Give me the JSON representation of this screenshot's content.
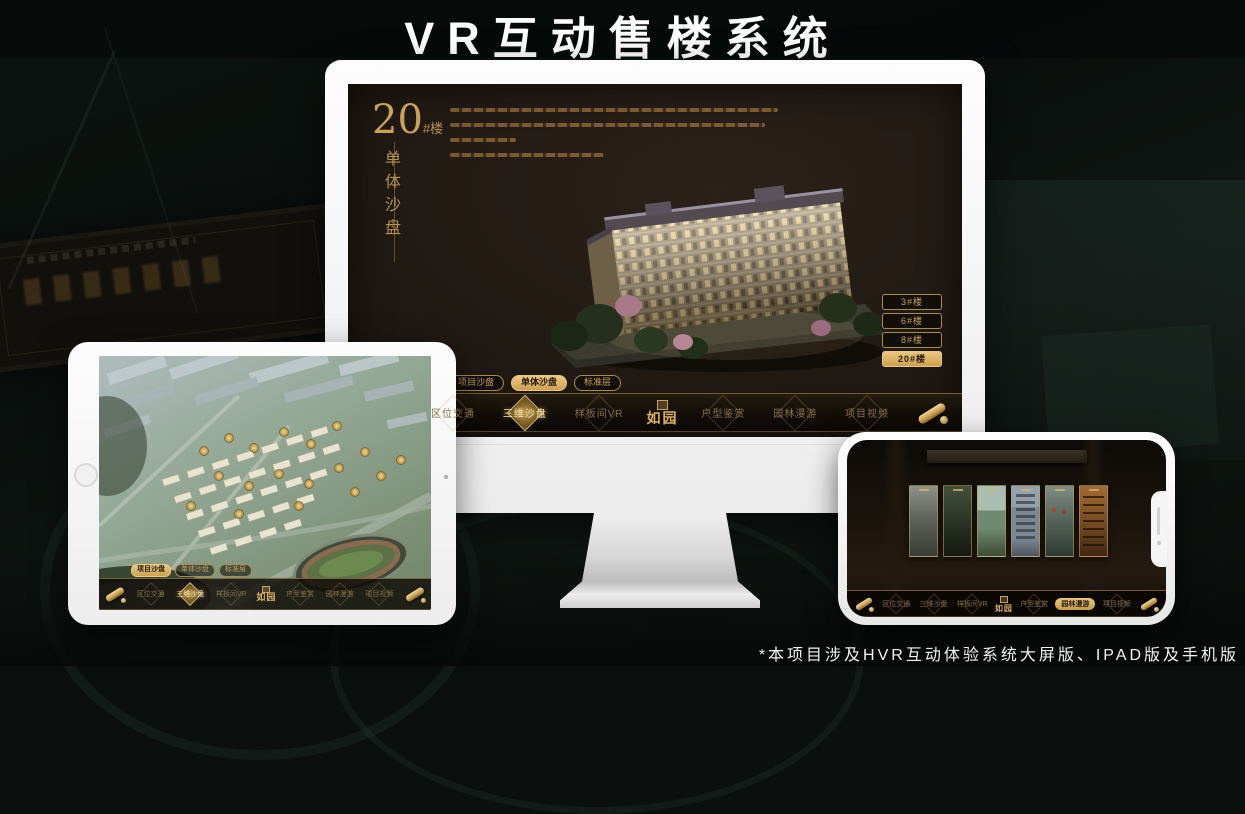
{
  "page": {
    "title": "VR互动售楼系统",
    "footnote": "*本项目涉及HVR互动体验系统大屏版、IPAD版及手机版"
  },
  "colors": {
    "gold": "#c9a158",
    "gold_bright": "#ecc87e",
    "selected_text": "#241a0c",
    "screen_bg": "#1f1812"
  },
  "app": {
    "logo_text": "如园",
    "nav_items": [
      "区位交通",
      "三维沙盘",
      "样板间VR",
      "户型鉴赏",
      "园林漫游",
      "项目视频"
    ]
  },
  "monitor": {
    "heading": {
      "number": "20",
      "suffix": "#楼",
      "vertical": "单体沙盘"
    },
    "floor_buttons": [
      {
        "label": "3#楼",
        "selected": false
      },
      {
        "label": "6#楼",
        "selected": false
      },
      {
        "label": "8#楼",
        "selected": false
      },
      {
        "label": "20#楼",
        "selected": true
      }
    ],
    "view_tabs": [
      {
        "label": "项目沙盘",
        "selected": false
      },
      {
        "label": "单体沙盘",
        "selected": true
      },
      {
        "label": "标准层",
        "selected": false
      }
    ],
    "active_nav": "三维沙盘"
  },
  "ipad": {
    "view_tabs": [
      {
        "label": "项目沙盘",
        "selected": true
      },
      {
        "label": "单体沙盘",
        "selected": false
      },
      {
        "label": "标准层",
        "selected": false
      }
    ],
    "active_nav": "三维沙盘"
  },
  "phone": {
    "active_nav": "园林漫游",
    "gallery_panel_count": 6
  }
}
